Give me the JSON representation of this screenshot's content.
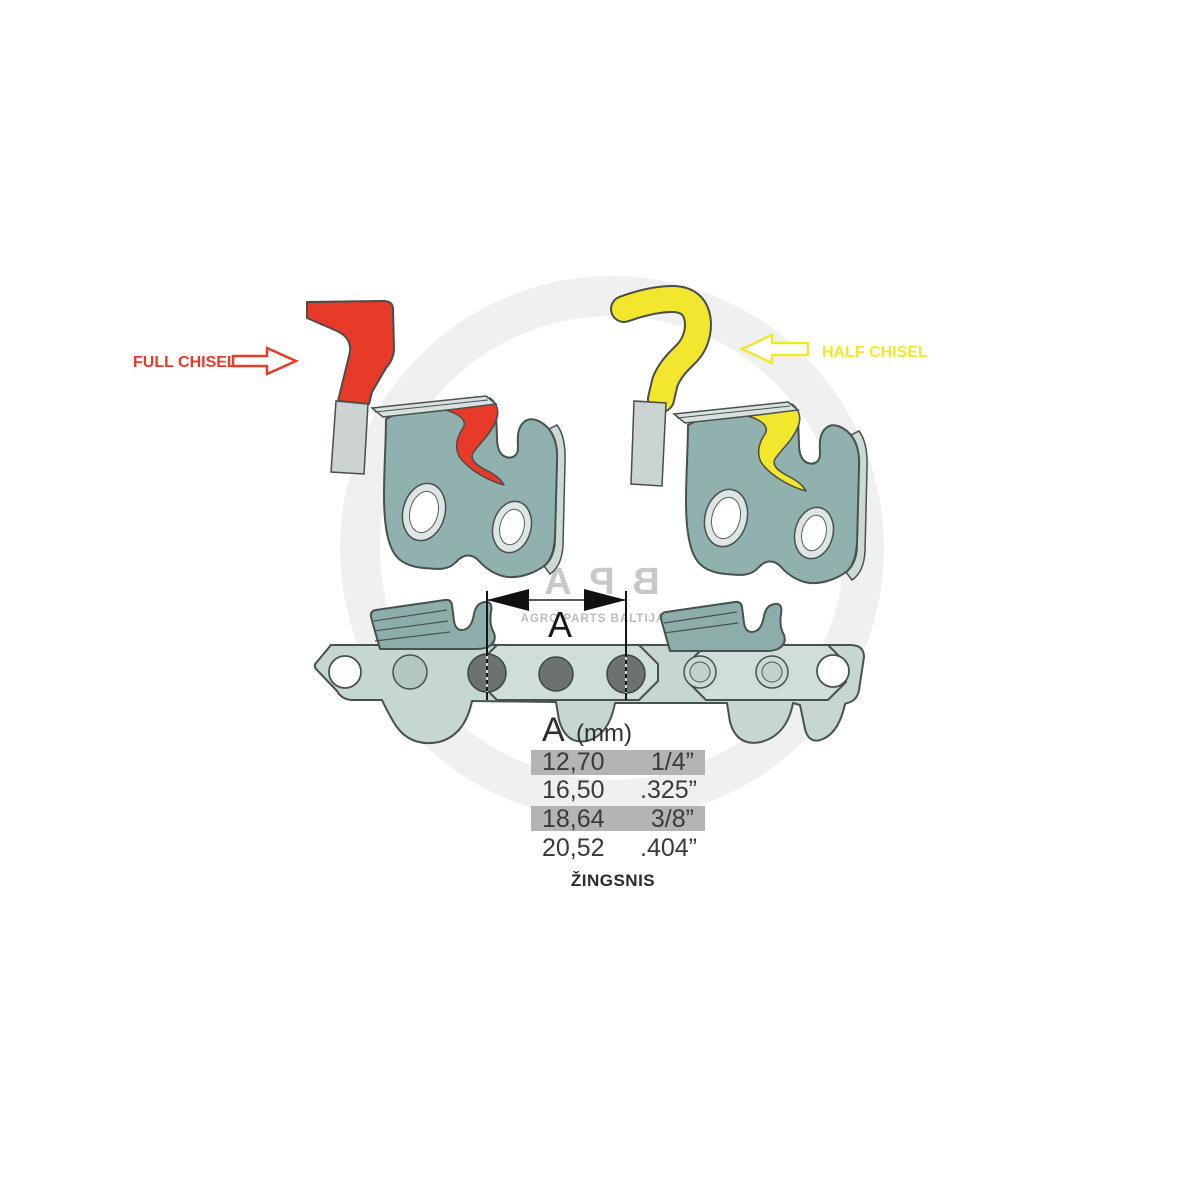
{
  "labels": {
    "full_chisel": "FULL CHISEL",
    "half_chisel": "HALF CHISEL",
    "dimension_letter": "A",
    "pitch_caption": "ŽINGSNIS"
  },
  "table": {
    "header": {
      "letter": "A",
      "unit": "(mm)"
    },
    "rows": [
      {
        "mm": "12,70",
        "inch": "1/4”",
        "highlighted": true
      },
      {
        "mm": "16,50",
        "inch": ".325”",
        "highlighted": false
      },
      {
        "mm": "18,64",
        "inch": "3/8”",
        "highlighted": true
      },
      {
        "mm": "20,52",
        "inch": ".404”",
        "highlighted": false
      }
    ]
  },
  "watermark": {
    "logo_letters": [
      "A",
      "P",
      "B"
    ],
    "tagline": "AGRO PARTS BALTIJA"
  },
  "colors": {
    "full_chisel_red": "#e73a28",
    "half_chisel_yellow": "#f3e72e",
    "cutter_teal": "#90b1ad",
    "link_light": "#c6d6d2",
    "tie_plate": "#cfdeda",
    "rivet_gray": "#6b7271",
    "outline_dark": "#47514f",
    "table_highlight": "#b4b4b4",
    "watermark_gray": "#c8c8c8"
  }
}
